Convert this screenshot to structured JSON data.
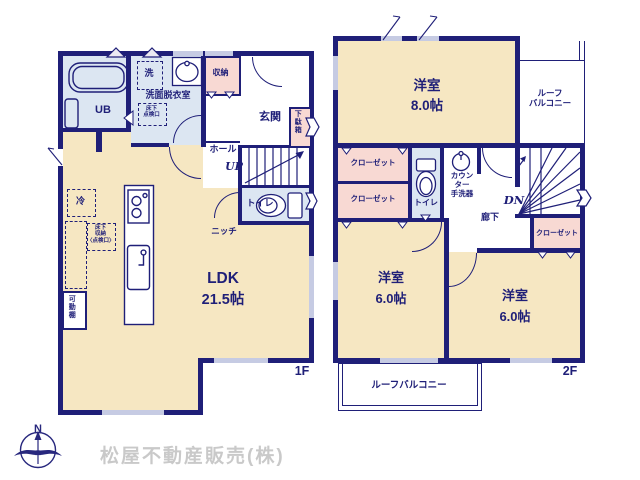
{
  "colors": {
    "wall": "#1f1f78",
    "room_floor": "#f6e7c2",
    "wet_floor": "#dce6f2",
    "closet_floor": "#f8d9d3",
    "window": "#c6cbe3",
    "logo_text": "#c9c9c9"
  },
  "f1": {
    "floor_label": "1F",
    "ub_label": "UB",
    "washer_label": "洗",
    "washroom_label": "洗面脱衣室",
    "hatch_label": "床下\n点検口",
    "storage_label": "収納",
    "entrance_label": "玄関",
    "shoebox_label": "下駄箱",
    "hall_label": "ホール",
    "up_label": "UP",
    "toilet_label": "トイレ",
    "niche_label": "ニッチ",
    "fridge_label": "冷",
    "underfloor_label": "床下\n収納\n〈点検口〉",
    "shelf_label": "可動棚",
    "ldk_name": "LDK",
    "ldk_size": "21.5帖"
  },
  "f2": {
    "floor_label": "2F",
    "room8_name": "洋室",
    "room8_size": "8.0帖",
    "balcony_top_label": "ルーフ\nバルコニー",
    "closet1_label": "クローゼット",
    "closet2_label": "クローゼット",
    "closet3_label": "クローゼット",
    "toilet_label": "トイレ",
    "basin_label": "カウン\nター\n手洗器",
    "dn_label": "DN",
    "hall_label": "廊下",
    "room6a_name": "洋室",
    "room6a_size": "6.0帖",
    "room6b_name": "洋室",
    "room6b_size": "6.0帖",
    "balcony_bottom_label": "ルーフバルコニー"
  },
  "footer": {
    "company": "松屋不動産販売(株)",
    "compass_n": "N"
  }
}
